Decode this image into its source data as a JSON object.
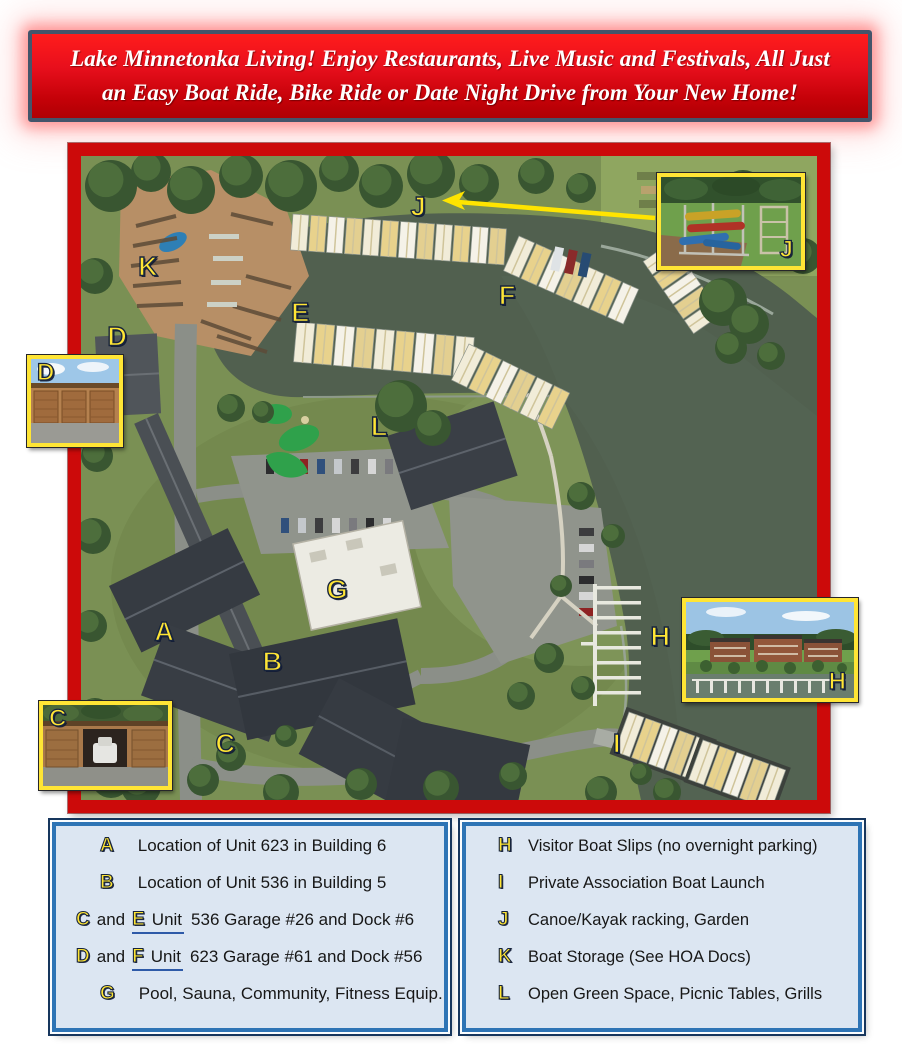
{
  "banner": {
    "line1": "Lake Minnetonka Living!  Enjoy Restaurants, Live Music and Festivals, All Just",
    "line2": "an Easy Boat Ride, Bike Ride or Date Night Drive from Your New Home!"
  },
  "map": {
    "labels": [
      {
        "letter": "A",
        "x": 11.3,
        "y": 73.9
      },
      {
        "letter": "B",
        "x": 26.0,
        "y": 78.6
      },
      {
        "letter": "C",
        "x": 19.6,
        "y": 91.3
      },
      {
        "letter": "D",
        "x": 4.9,
        "y": 28.1
      },
      {
        "letter": "E",
        "x": 29.8,
        "y": 24.4
      },
      {
        "letter": "F",
        "x": 57.9,
        "y": 21.7
      },
      {
        "letter": "G",
        "x": 34.8,
        "y": 67.4
      },
      {
        "letter": "H",
        "x": 78.7,
        "y": 74.7
      },
      {
        "letter": "I",
        "x": 72.8,
        "y": 91.3
      },
      {
        "letter": "J",
        "x": 45.8,
        "y": 7.9
      },
      {
        "letter": "K",
        "x": 9.1,
        "y": 17.2
      },
      {
        "letter": "L",
        "x": 40.5,
        "y": 42.1
      }
    ],
    "insets": [
      {
        "letter": "D",
        "subject": "garage-doors-photo"
      },
      {
        "letter": "C",
        "subject": "garage-with-boat-photo"
      },
      {
        "letter": "J",
        "subject": "canoe-kayak-rack-photo"
      },
      {
        "letter": "H",
        "subject": "condo-building-marina-photo"
      }
    ]
  },
  "legend_left": {
    "rows": [
      {
        "badge": "A",
        "text": "Location of Unit 623 in Building 6"
      },
      {
        "badge": "B",
        "text": "Location of Unit 536 in Building 5"
      },
      {
        "badge": "C",
        "and_word": "and",
        "badge2": "E",
        "underline_word": "Unit",
        "text": "536 Garage #26 and Dock #6"
      },
      {
        "badge": "D",
        "and_word": "and",
        "badge2": "F",
        "underline_word": "Unit",
        "text": "623 Garage #61 and Dock #56"
      },
      {
        "badge": "G",
        "text": "Pool, Sauna, Community, Fitness Equip."
      }
    ]
  },
  "legend_right": {
    "rows": [
      {
        "badge": "H",
        "text": "Visitor Boat Slips (no overnight parking)"
      },
      {
        "badge": "I",
        "text": "Private Association Boat Launch"
      },
      {
        "badge": "J",
        "text": "Canoe/Kayak racking, Garden"
      },
      {
        "badge": "K",
        "text": "Boat Storage (See HOA Docs)"
      },
      {
        "badge": "L",
        "text": "Open Green Space, Picnic Tables, Grills"
      }
    ]
  },
  "colors": {
    "banner_red": "#d90f18",
    "banner_border": "#44546a",
    "map_border": "#cc0a0a",
    "label_yellow": "#ffe535",
    "legend_border": "#2e74b5",
    "legend_bg": "#dce6f2",
    "legend_outline": "#17365d"
  }
}
